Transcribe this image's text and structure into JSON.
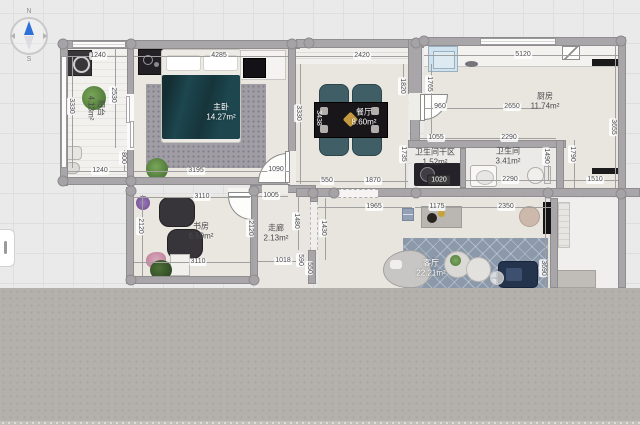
{
  "compass": {
    "north": "N",
    "south": "S"
  },
  "rooms": {
    "balcony": {
      "name": "阳台",
      "area": "4.13m²"
    },
    "master": {
      "name": "主卧",
      "area": "14.27m²"
    },
    "dining": {
      "name": "餐厅",
      "area": "8.60m²"
    },
    "kitchen": {
      "name": "厨房",
      "area": "11.74m²"
    },
    "bath_dry": {
      "name": "卫生间干区",
      "area": "1.52m²"
    },
    "bath": {
      "name": "卫生间",
      "area": "3.41m²"
    },
    "study": {
      "name": "书房",
      "area": "6.59m²"
    },
    "corridor": {
      "name": "走廊",
      "area": "2.13m²"
    },
    "living": {
      "name": "客厅",
      "area": "22.21m²"
    }
  },
  "dims": {
    "h": {
      "balcony_top": "1240",
      "bedroom_top": "4285",
      "dining_top": "2420",
      "kitchen_top": "5120",
      "balcony_bottom": "1240",
      "bedroom_bottom": "3195",
      "bedroom_door": "1090",
      "dining_550": "550",
      "dining_1870": "1870",
      "kitchen_960": "960",
      "kitchen_2650": "2650",
      "dry_1055": "1055",
      "bath_top": "2290",
      "bath_bottom": "2290",
      "right_1510": "1510",
      "corridor_1005": "1005",
      "corridor_1018": "1018",
      "study_top": "3110",
      "study_bottom": "3110",
      "hall_1965": "1965",
      "living_1175": "1175",
      "living_2350": "2350"
    },
    "v": {
      "balcony_3330": "3330",
      "balcony_2530": "2530",
      "balcony_800": "800",
      "dining_3330": "3330",
      "dining_1820": "1820",
      "dining_1735": "1735",
      "kitchen_1765": "1765",
      "kitchen_3655": "3655",
      "bath_1490": "1490",
      "right_1790": "1790",
      "study_2120_l": "2120",
      "study_2120_r": "2120",
      "corridor_1480": "1480",
      "corridor_1430": "1430",
      "corridor_590": "590",
      "corridor_550": "550",
      "living_3690": "3690",
      "table_3438": "3438"
    },
    "selected": "1020"
  },
  "colors": {
    "wall": "#a8a6a9",
    "floor": "#e9e6e0",
    "compass_needle": "#2f6fd8",
    "duvet": "#1d464e",
    "chair_teal": "#41626a",
    "living_rug": "#8b99aa",
    "selected_dim_bg": "#3b3b3b"
  }
}
